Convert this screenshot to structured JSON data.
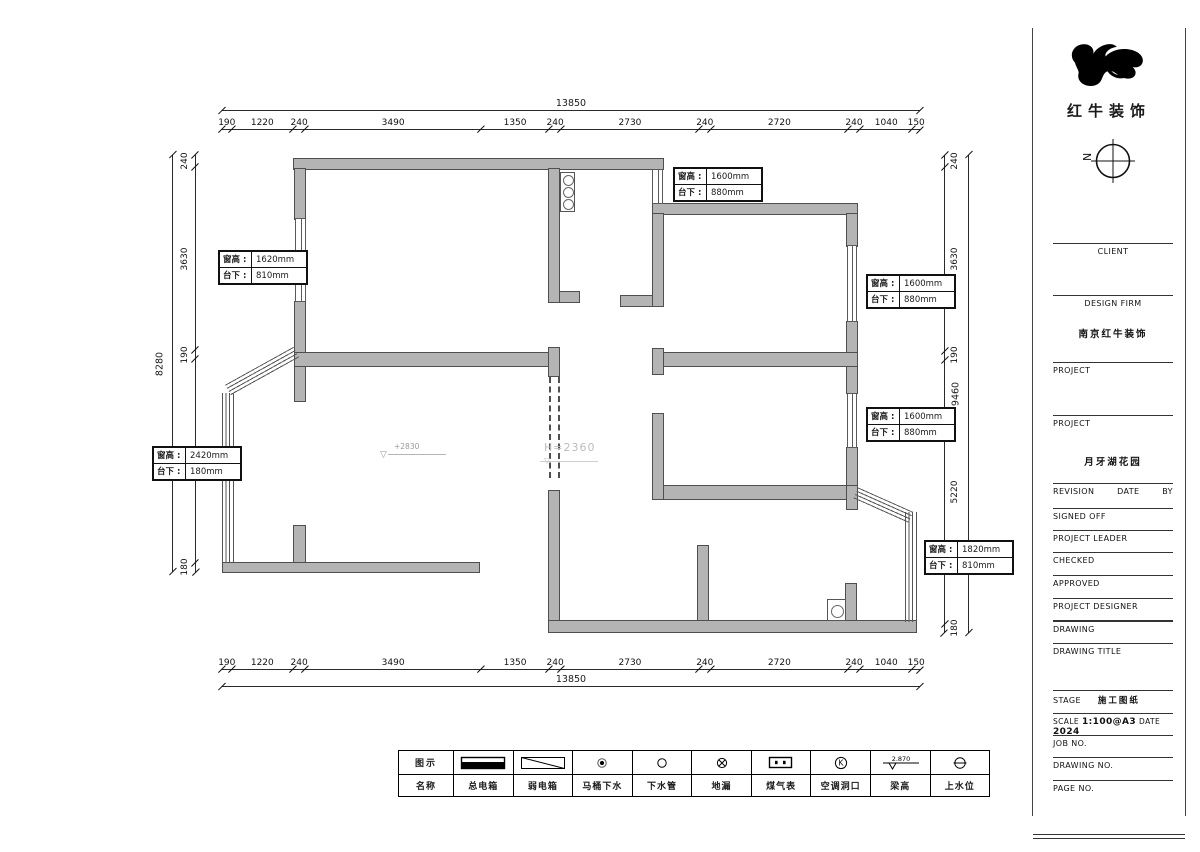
{
  "title_block": {
    "logo_text": "红牛装饰",
    "north_label": "N",
    "client_label": "CLIENT",
    "design_firm_label": "DESIGN FIRM",
    "design_firm_value": "南京红牛装饰",
    "project1_label": "PROJECT",
    "project2_label": "PROJECT",
    "project2_value": "月牙湖花园",
    "revision_label": "REVISION",
    "date_label": "DATE",
    "by_label": "BY",
    "signed_off_label": "SIGNED OFF",
    "project_leader_label": "PROJECT LEADER",
    "checked_label": "CHECKED",
    "approved_label": "APPROVED",
    "project_designer_label": "PROJECT DESIGNER",
    "drawing_label": "DRAWING",
    "drawing_title_label": "DRAWING TITLE",
    "stage_label": "STAGE",
    "stage_value": "施工图纸",
    "scale_label": "SCALE",
    "scale_value": "1:100@A3",
    "date2_label": "DATE",
    "date_value": "2024",
    "job_no_label": "JOB NO.",
    "drawing_no_label": "DRAWING NO.",
    "page_no_label": "PAGE NO."
  },
  "dimensions": {
    "top": {
      "total": "13850",
      "segments": [
        190,
        1220,
        240,
        3490,
        1350,
        240,
        2730,
        240,
        2720,
        240,
        1040,
        150
      ]
    },
    "bottom": {
      "total": "13850",
      "segments": [
        190,
        1220,
        240,
        3490,
        1350,
        240,
        2730,
        240,
        2720,
        240,
        1040,
        150
      ]
    },
    "left": {
      "total": "8280",
      "segments": [
        240,
        3630,
        190,
        4040,
        180
      ]
    },
    "right": {
      "total": "9460",
      "segments": [
        240,
        3630,
        190,
        5220,
        180
      ]
    }
  },
  "window_labels": [
    {
      "k1": "窗高",
      "v1": "1620mm",
      "k2": "台下",
      "v2": "810mm"
    },
    {
      "k1": "窗高",
      "v1": "1600mm",
      "k2": "台下",
      "v2": "880mm"
    },
    {
      "k1": "窗高",
      "v1": "1600mm",
      "k2": "台下",
      "v2": "880mm"
    },
    {
      "k1": "窗高",
      "v1": "1600mm",
      "k2": "台下",
      "v2": "880mm"
    },
    {
      "k1": "窗高",
      "v1": "1820mm",
      "k2": "台下",
      "v2": "810mm"
    },
    {
      "k1": "窗高",
      "v1": "2420mm",
      "k2": "台下",
      "v2": "180mm"
    }
  ],
  "annotations": {
    "living_level": "+2830",
    "beam_opening": "H=2360"
  },
  "legend": {
    "row1_header": "图示",
    "row2_header": "名称",
    "beam_value": "2.870",
    "items": [
      {
        "icon": "main-power-box-icon",
        "label": "总电箱"
      },
      {
        "icon": "weak-power-box-icon",
        "label": "弱电箱"
      },
      {
        "icon": "toilet-drain-icon",
        "label": "马桶下水"
      },
      {
        "icon": "drain-pipe-icon",
        "label": "下水管"
      },
      {
        "icon": "floor-drain-icon",
        "label": "地漏"
      },
      {
        "icon": "gas-meter-icon",
        "label": "煤气表"
      },
      {
        "icon": "ac-hole-icon",
        "label": "空调洞口"
      },
      {
        "icon": "beam-height-icon",
        "label": "梁高"
      },
      {
        "icon": "water-supply-icon",
        "label": "上水位"
      }
    ]
  },
  "colors": {
    "wall_fill": "#b4b4b4",
    "wall_edge": "#4f4f4f",
    "line": "#2a2a2a",
    "faint_annotation": "#b5b5b5"
  }
}
